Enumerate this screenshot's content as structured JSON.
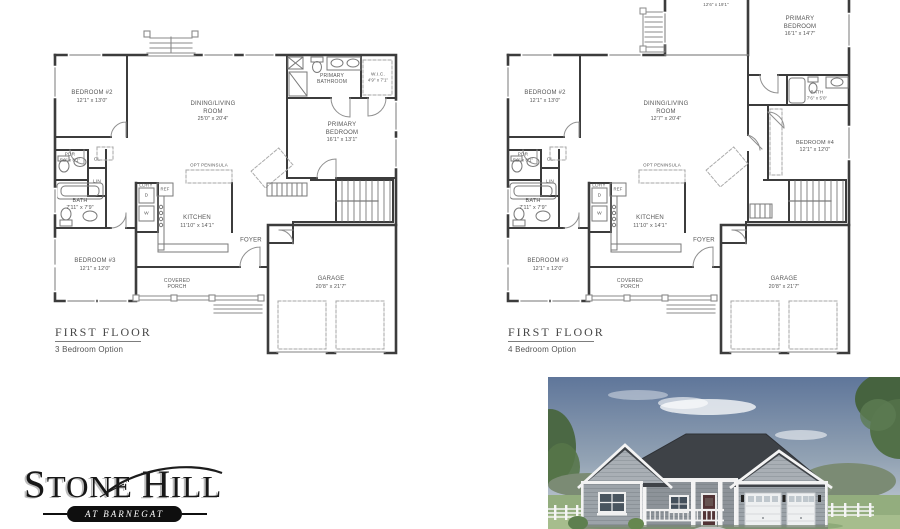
{
  "plans": [
    {
      "title": "FIRST FLOOR",
      "subtitle": "3 Bedroom Option",
      "rooms": {
        "bedroom2": {
          "name": "BEDROOM #2",
          "dims": "12'1\" x 13'0\""
        },
        "dining": {
          "name": "DINING/LIVING ROOM",
          "dims": "25'0\" x 20'4\""
        },
        "primary_bathroom": {
          "name": "PRIMARY BATHROOM"
        },
        "wic": {
          "name": "W.I.C.",
          "dims": "4'9\" x 7'1\""
        },
        "primary_bedroom": {
          "name": "PRIMARY BEDROOM",
          "dims": "16'1\" x 13'1\""
        },
        "pdr": {
          "name": "PDR",
          "dims": "5'0\" x 6'1\""
        },
        "bath": {
          "name": "BATH",
          "dims": "7'11\" x 7'9\""
        },
        "laundry": {
          "name": "LDRY",
          "dryer": "D",
          "washer": "W"
        },
        "closet": {
          "name": "CL"
        },
        "linen": {
          "name": "LIN"
        },
        "fridge": {
          "name": "REF"
        },
        "kitchen": {
          "name": "KITCHEN",
          "dims": "11'10\" x 14'1\""
        },
        "opt_peninsula": {
          "name": "OPT PENINSULA"
        },
        "foyer": {
          "name": "FOYER"
        },
        "bedroom3": {
          "name": "BEDROOM #3",
          "dims": "12'1\" x 12'0\""
        },
        "covered_porch": {
          "name": "COVERED PORCH"
        },
        "garage": {
          "name": "GARAGE",
          "dims": "20'8\" x 21'7\""
        }
      }
    },
    {
      "title": "FIRST FLOOR",
      "subtitle": "4 Bedroom Option",
      "rooms": {
        "sunroom": {
          "name": "SUNROOM",
          "dims": "12'6\" x 19'1\""
        },
        "primary_bedroom": {
          "name": "PRIMARY BEDROOM",
          "dims": "16'1\" x 14'7\""
        },
        "primary_bath": {
          "name": "BATH",
          "dims": "7'6\" x 5'0\""
        },
        "bedroom4": {
          "name": "BEDROOM #4",
          "dims": "12'1\" x 12'0\""
        },
        "bedroom2": {
          "name": "BEDROOM #2",
          "dims": "12'1\" x 13'0\""
        },
        "dining": {
          "name": "DINING/LIVING ROOM",
          "dims": "12'7\" x 20'4\""
        },
        "pdr": {
          "name": "PDR",
          "dims": "5'0\" x 6'1\""
        },
        "bath": {
          "name": "BATH",
          "dims": "7'11\" x 7'9\""
        },
        "laundry": {
          "name": "LDRY",
          "dryer": "D",
          "washer": "W"
        },
        "closet": {
          "name": "CL"
        },
        "linen": {
          "name": "LIN"
        },
        "fridge": {
          "name": "REF"
        },
        "kitchen": {
          "name": "KITCHEN",
          "dims": "11'10\" x 14'1\""
        },
        "opt_peninsula": {
          "name": "OPT PENINSULA"
        },
        "foyer": {
          "name": "FOYER"
        },
        "bedroom3": {
          "name": "BEDROOM #3",
          "dims": "12'1\" x 12'0\""
        },
        "covered_porch": {
          "name": "COVERED PORCH"
        },
        "garage": {
          "name": "GARAGE",
          "dims": "20'8\" x 21'7\""
        }
      }
    }
  ],
  "logo": {
    "word1": "STONE",
    "word2": "HILL",
    "tagline": "AT BARNEGAT"
  },
  "colors": {
    "logo_black": "#0f0f0f",
    "plan_wall_gray": "#3c3c3c",
    "label_gray": "#565656",
    "roof_gray": "#3f4348",
    "siding_gray": "#9aa1a7",
    "sky_blue": "#5f769a",
    "grass_green": "#93ad7e"
  }
}
